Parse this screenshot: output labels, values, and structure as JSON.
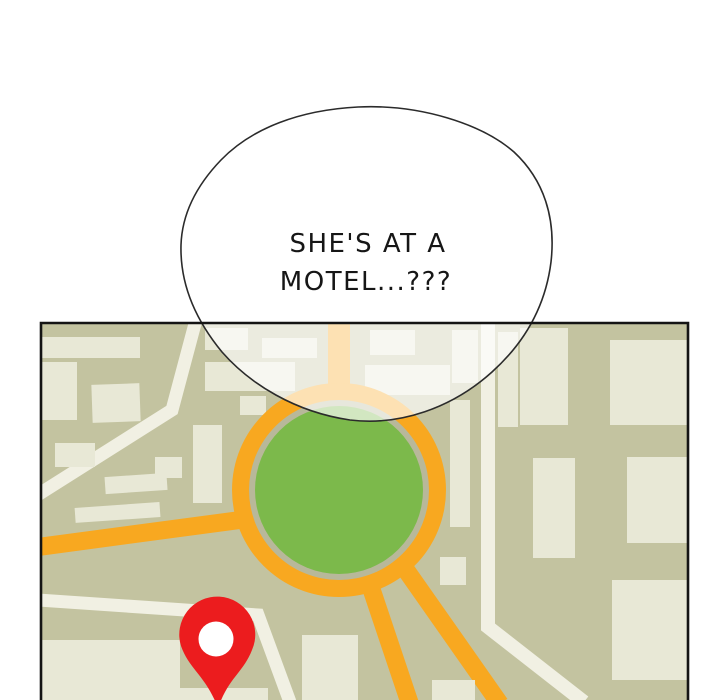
{
  "panel": {
    "speech_bubble": {
      "line1": "SHE'S AT A",
      "line2": "MOTEL...???"
    },
    "map": {
      "pin_icon": "location-pin-icon",
      "feature": "roundabout-with-green-island"
    }
  },
  "colors": {
    "page_bg": "#ffffff",
    "map_bg": "#c3c3a0",
    "building": "#e8e8d6",
    "road_white": "#f1f0e3",
    "road_orange": "#f8a820",
    "roundabout_green": "#7cb94b",
    "ring_gray": "#b8b89a",
    "pin_red": "#ec1c1e",
    "map_border": "#141414",
    "bubble_fill": "rgba(255,255,255,0.66)",
    "bubble_stroke": "#2b2b2b",
    "text_color": "#161616"
  }
}
